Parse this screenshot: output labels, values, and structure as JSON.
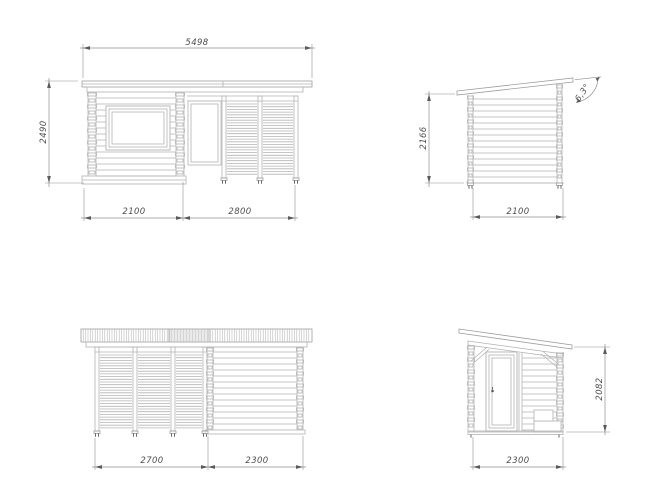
{
  "drawing": {
    "title": "garden-house-four-view-technical-drawing",
    "views": {
      "front": {
        "name": "front-elevation",
        "overall_width_mm": "5498",
        "overall_height_mm": "2490",
        "segment_left_mm": "2100",
        "segment_right_mm": "2800"
      },
      "side_right": {
        "name": "side-elevation-closed",
        "height_mm": "2166",
        "width_mm": "2100",
        "roof_angle": "6,3°"
      },
      "rear": {
        "name": "rear-elevation",
        "segment_left_mm": "2700",
        "segment_right_mm": "2300"
      },
      "side_left": {
        "name": "side-elevation-door",
        "height_mm": "2082",
        "width_mm": "2300"
      }
    },
    "colors": {
      "background": "#ffffff",
      "line": "#b3b3b3",
      "line_dark": "#9e9e9e",
      "dimension": "#8f8f8f",
      "arrow": "#5a5a5a",
      "text": "#4d4d4d"
    }
  }
}
